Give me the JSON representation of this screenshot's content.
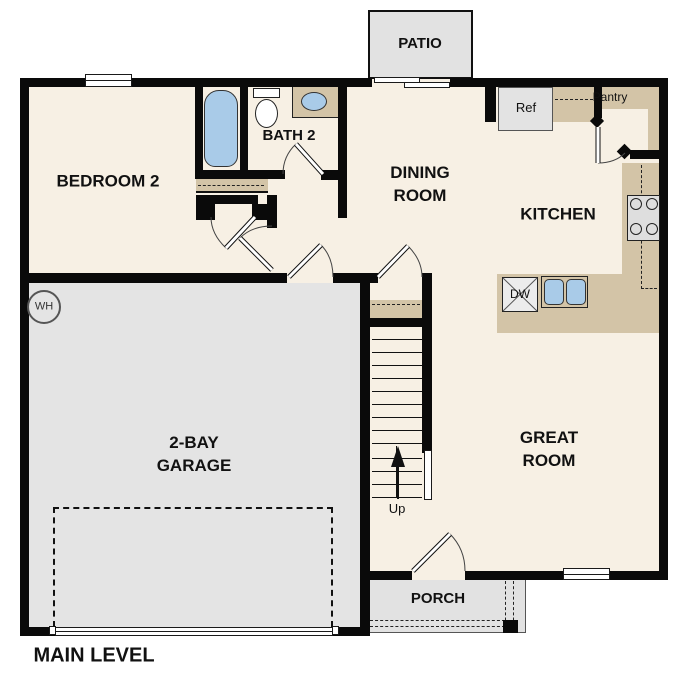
{
  "title": "MAIN LEVEL",
  "rooms": {
    "bedroom2": "BEDROOM 2",
    "bath2": "BATH 2",
    "dining_line1": "DINING",
    "dining_line2": "ROOM",
    "kitchen": "KITCHEN",
    "great_line1": "GREAT",
    "great_line2": "ROOM",
    "garage_line1": "2-BAY",
    "garage_line2": "GARAGE",
    "patio": "PATIO",
    "porch": "PORCH",
    "pantry": "Pantry"
  },
  "fixtures": {
    "refrigerator": "Ref",
    "dishwasher": "DW",
    "water_heater": "WH",
    "stairs_direction": "Up"
  },
  "colors": {
    "wall": "#0a0a0a",
    "floor": "#f7f0e4",
    "garage_floor": "#e4e4e4",
    "outdoor_concrete": "#e2e2e2",
    "counter_tan": "#d3c4a7",
    "fixture_blue": "#a9cbe8",
    "appliance_gray": "#e3e3e3"
  }
}
